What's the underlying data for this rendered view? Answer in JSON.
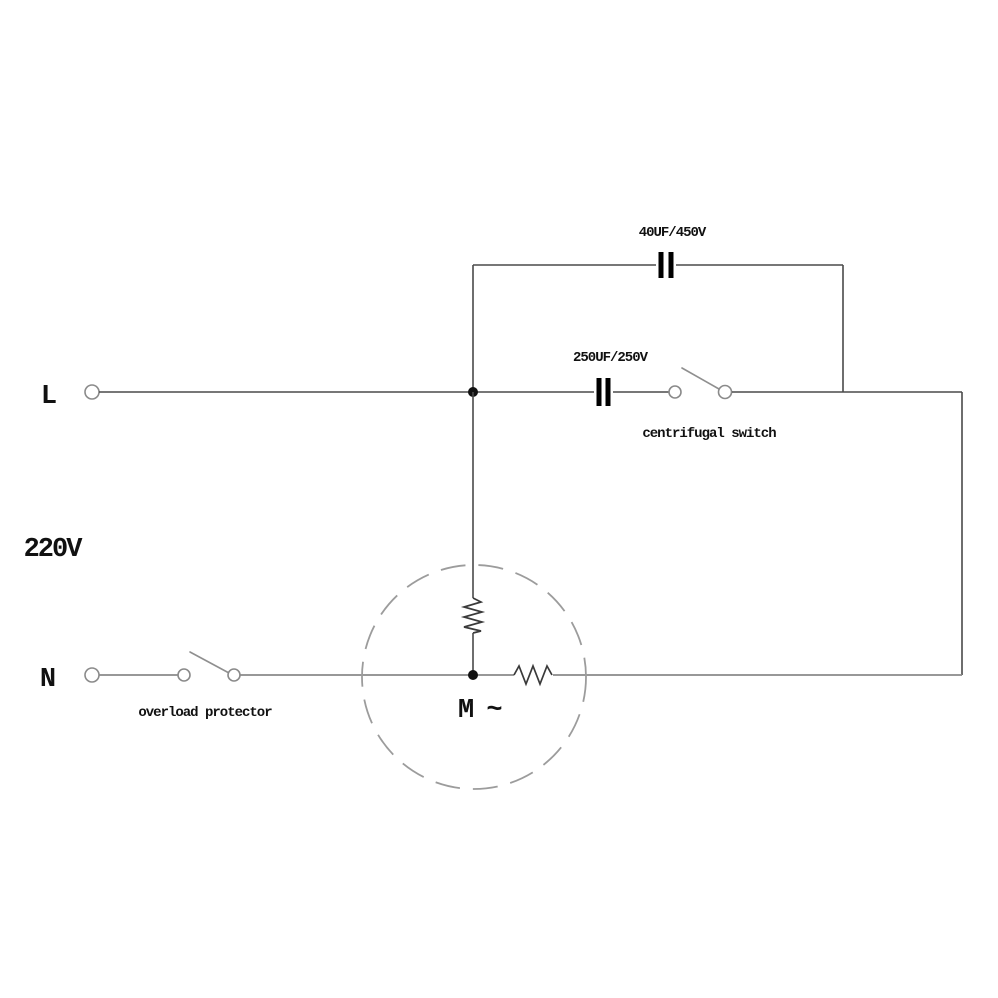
{
  "diagram": {
    "labels": {
      "main_capacitor": "40UF/450V",
      "start_capacitor": "250UF/250V",
      "centrifugal_switch": "centrifugal switch",
      "overload_protector": "overload protector",
      "line_live": "L",
      "line_neutral": "N",
      "supply_voltage": "220V",
      "motor": "M ~"
    },
    "components": {
      "main_capacitor_value": "40UF/450V",
      "start_capacitor_value": "250UF/250V",
      "supply": "220V single phase, L and N terminals",
      "motor_type": "single-phase AC motor with main and auxiliary windings"
    },
    "colors": {
      "background": "#ffffff",
      "wire": "#4a4a4a",
      "wire_gray": "#8a8a8a",
      "component": "#000000",
      "text": "#111111",
      "motor_ring": "#9c9c9c"
    }
  }
}
